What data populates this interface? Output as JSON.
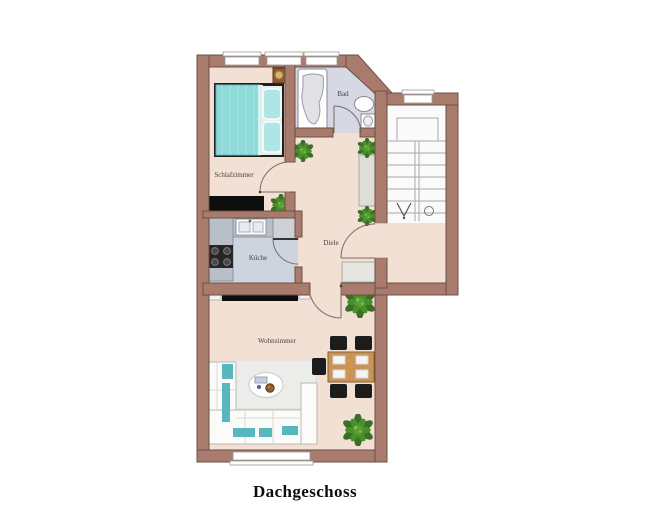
{
  "title": "Dachgeschoss",
  "rooms": {
    "bedroom": {
      "label": "Schlafzimmer"
    },
    "bathroom": {
      "label": "Bad"
    },
    "kitchen": {
      "label": "Küche"
    },
    "hallway": {
      "label": "Diele"
    },
    "living_room": {
      "label": "Wohnzimmer"
    }
  },
  "colors": {
    "wall_fill": "#a97b6d",
    "wall_outline": "#6b4f45",
    "floor": "#f3e0d4",
    "kitchen_floor": "#ced4dd",
    "bathroom_floor": "#d6d8e4",
    "stair_floor": "#fafafa",
    "furniture_teal": "#8ed9d9",
    "furniture_wood": "#c99455",
    "plant_green": "#3e7d26",
    "dark_furniture": "#111111"
  }
}
